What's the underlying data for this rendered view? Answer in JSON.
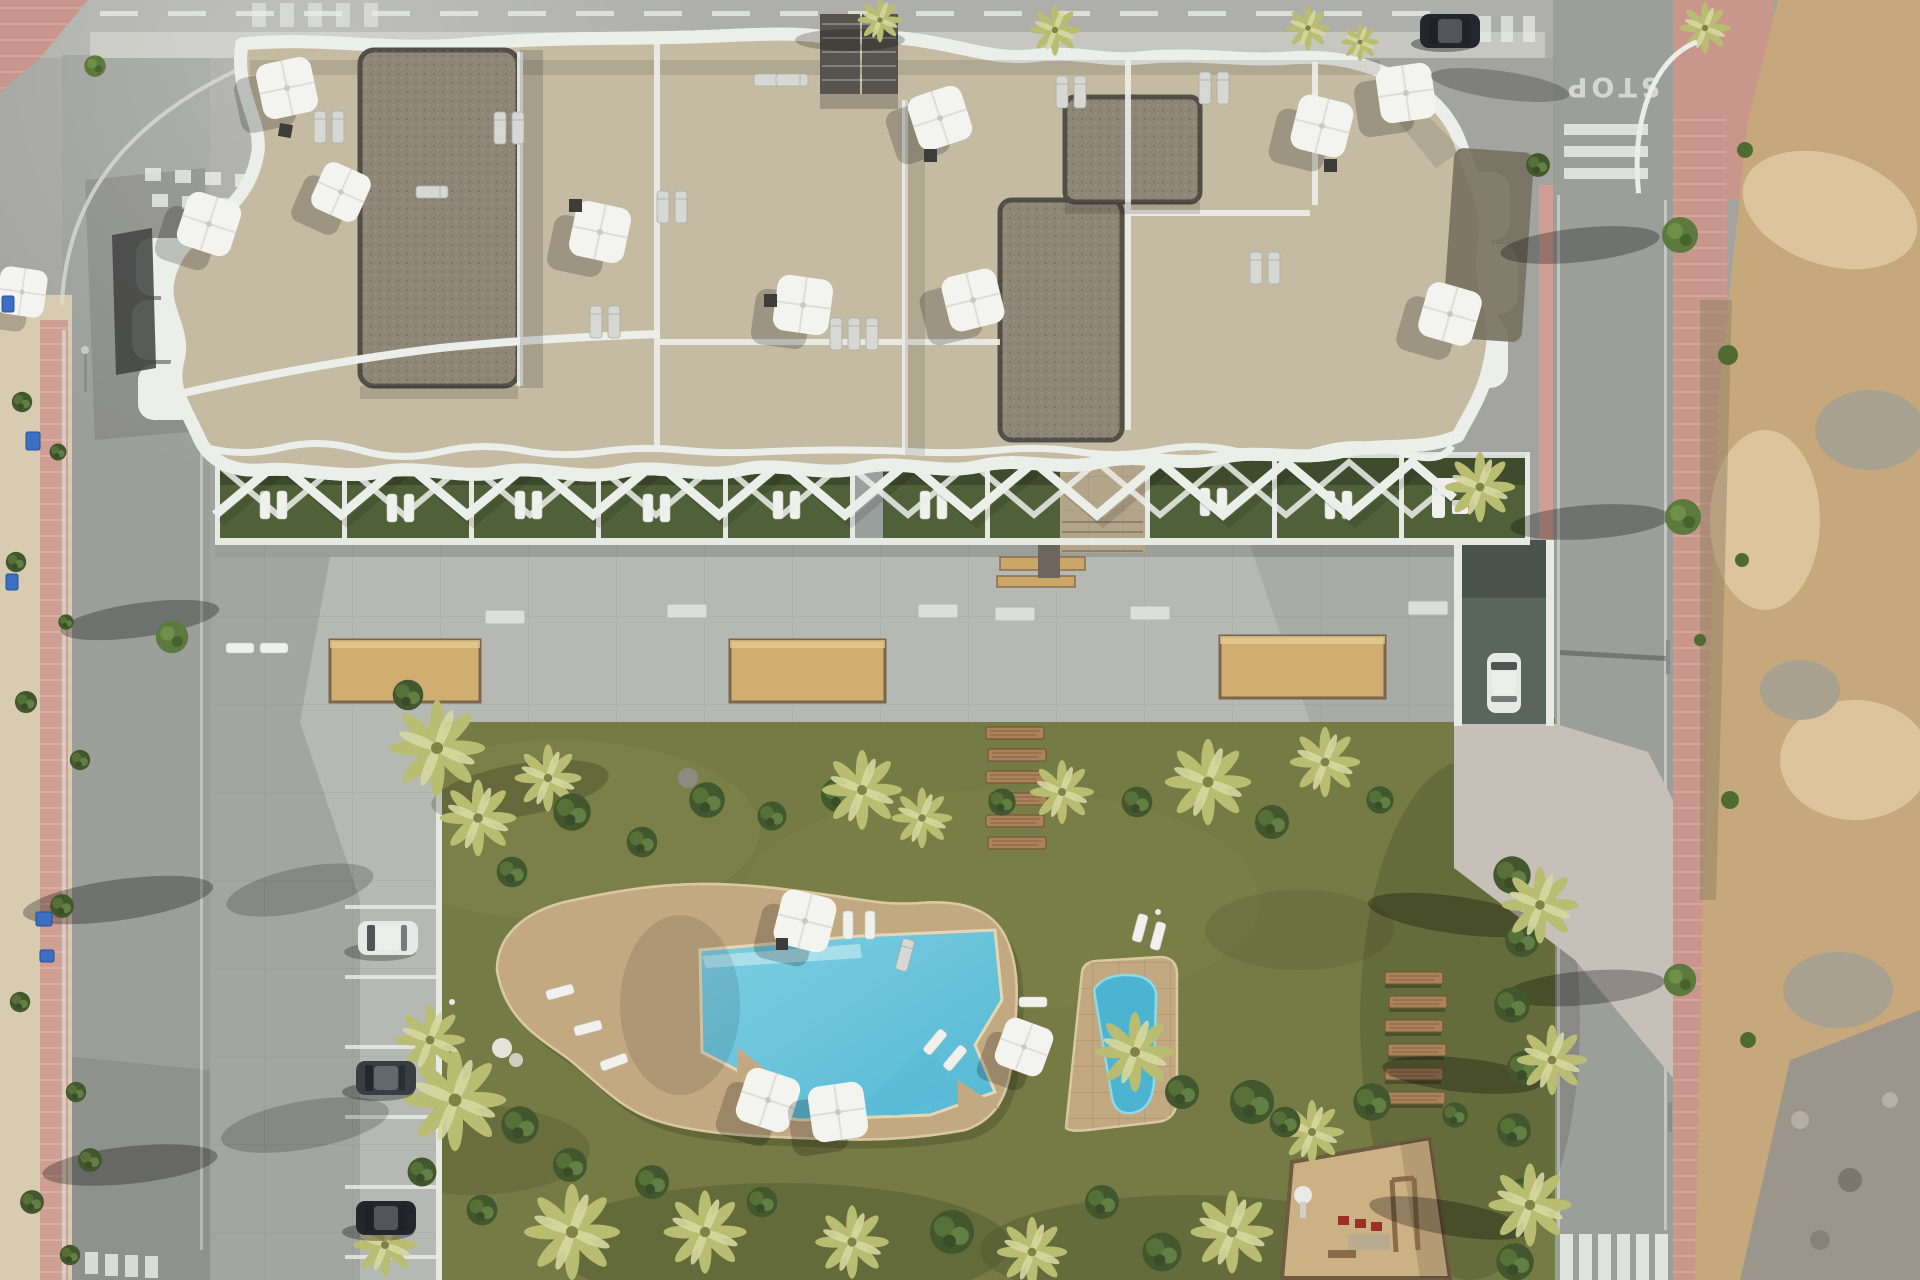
{
  "meta": {
    "description": "Aerial top-down 3D architectural render of a modern residential apartment complex with rooftop terraces, communal garden, free-form swimming pool, kids pool, parking, surrounding roads and an undeveloped dirt lot"
  },
  "scene": {
    "road_marking_stop_label": "STOP",
    "counts": {
      "rooftop_parasols": 11,
      "pool_parasols": 4,
      "parked_cars": 3,
      "cars_on_road": 2,
      "sand_planters": 3,
      "wooden_steps": 6,
      "lawn_bench_planks": 6,
      "pools": 2,
      "garden_units": 9
    },
    "palette": {
      "roadBase": "#a3a4a0",
      "roadTop": "#aeafab",
      "roadSide": "#9c9e9a",
      "topSidewalk": "#c6c7c1",
      "sidewalkPink": "#c9968b",
      "pathPink": "#cf9f93",
      "sandy": "#d7cbb2",
      "dirt": "#c7a87c",
      "dirtLight": "#dcc49c",
      "dirtRock": "#a8a18f",
      "rubble": "#9b968c",
      "weedGreen": "#4e6b33",
      "lawn": "#747b44",
      "lawnLight": "#8a9053",
      "lawnShadow": "#4c5430",
      "deckConcrete": "#b6b9b3",
      "wallWhite": "#e7e9e5",
      "sandPlanter": "#d0ae72",
      "plankWood": "#ab835a",
      "plankEdge": "#74573c",
      "poolDeck": "#c2a982",
      "poolWater": "#7ecfe2",
      "poolWaterDeep": "#54b8d4",
      "poolShelf": "#b9e6ef",
      "kidsPool": "#4cb4d0",
      "terraceBeige": "#c5bba2",
      "gravelRoof": "#8e8777",
      "darkRoof": "#56544c",
      "whiteStruct": "#eceeea",
      "gardenGrass": "#50613a",
      "pierGray": "#9aa09e",
      "hedge": "#42572e",
      "palmGreen": "#b9bd72",
      "palmLight": "#d6d8a0",
      "palmCore": "#7e8448",
      "treeGreen": "#5c7a3e",
      "carDark": "#23262c",
      "carGray": "#383e44",
      "carWhite": "#e7e9e7",
      "binBlue": "#3b6fc4",
      "playSand": "#ccb184",
      "playRed": "#9e2f28",
      "woodFrame": "#8a6a48",
      "lineWhite": "#eceeea",
      "stopText": "#e4e4e0",
      "rampDark": "#5a655c",
      "apron": "#c7c0b8",
      "stoneEntrance": "#b3a58a",
      "stepTan": "#caa768"
    }
  }
}
